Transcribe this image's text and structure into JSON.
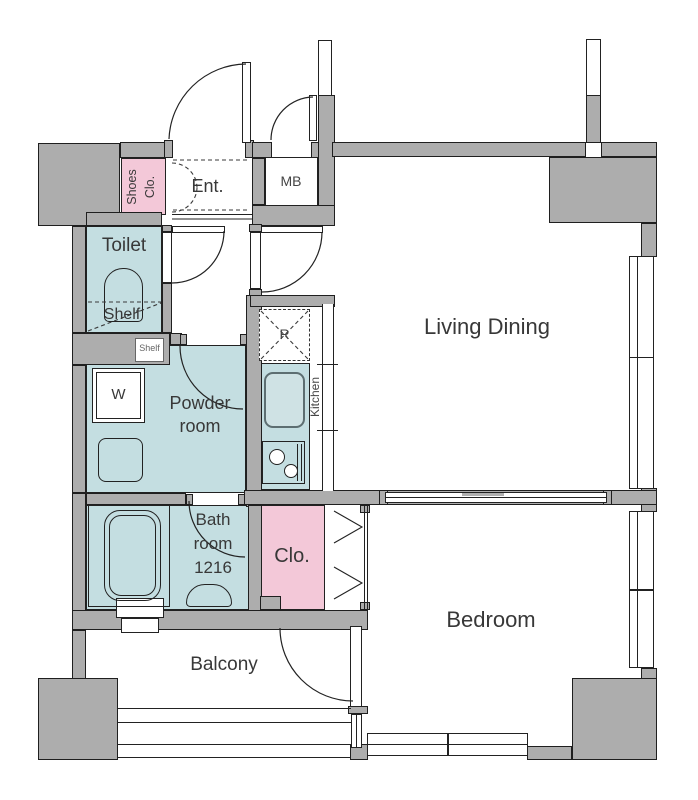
{
  "labels": {
    "entrance": "Ent.",
    "meter_box": "MB",
    "shoes_closet": "Shoes Clo.",
    "toilet": "Toilet",
    "toilet_shelf": "Shelf",
    "shelf_box": "Shelf",
    "washer": "W",
    "powder_room": "Powder room",
    "kitchen": "Kitchen",
    "refrigerator": "R",
    "living_dining": "Living Dining",
    "bathroom": "Bath room 1216",
    "closet": "Clo.",
    "bedroom": "Bedroom",
    "balcony": "Balcony"
  },
  "colors": {
    "wall_fill": "#adadad",
    "wet_area_fill": "#c4dee1",
    "closet_fill": "#f3c8d8",
    "floor_fill": "#ffffff",
    "line": "#1f1f1f"
  }
}
